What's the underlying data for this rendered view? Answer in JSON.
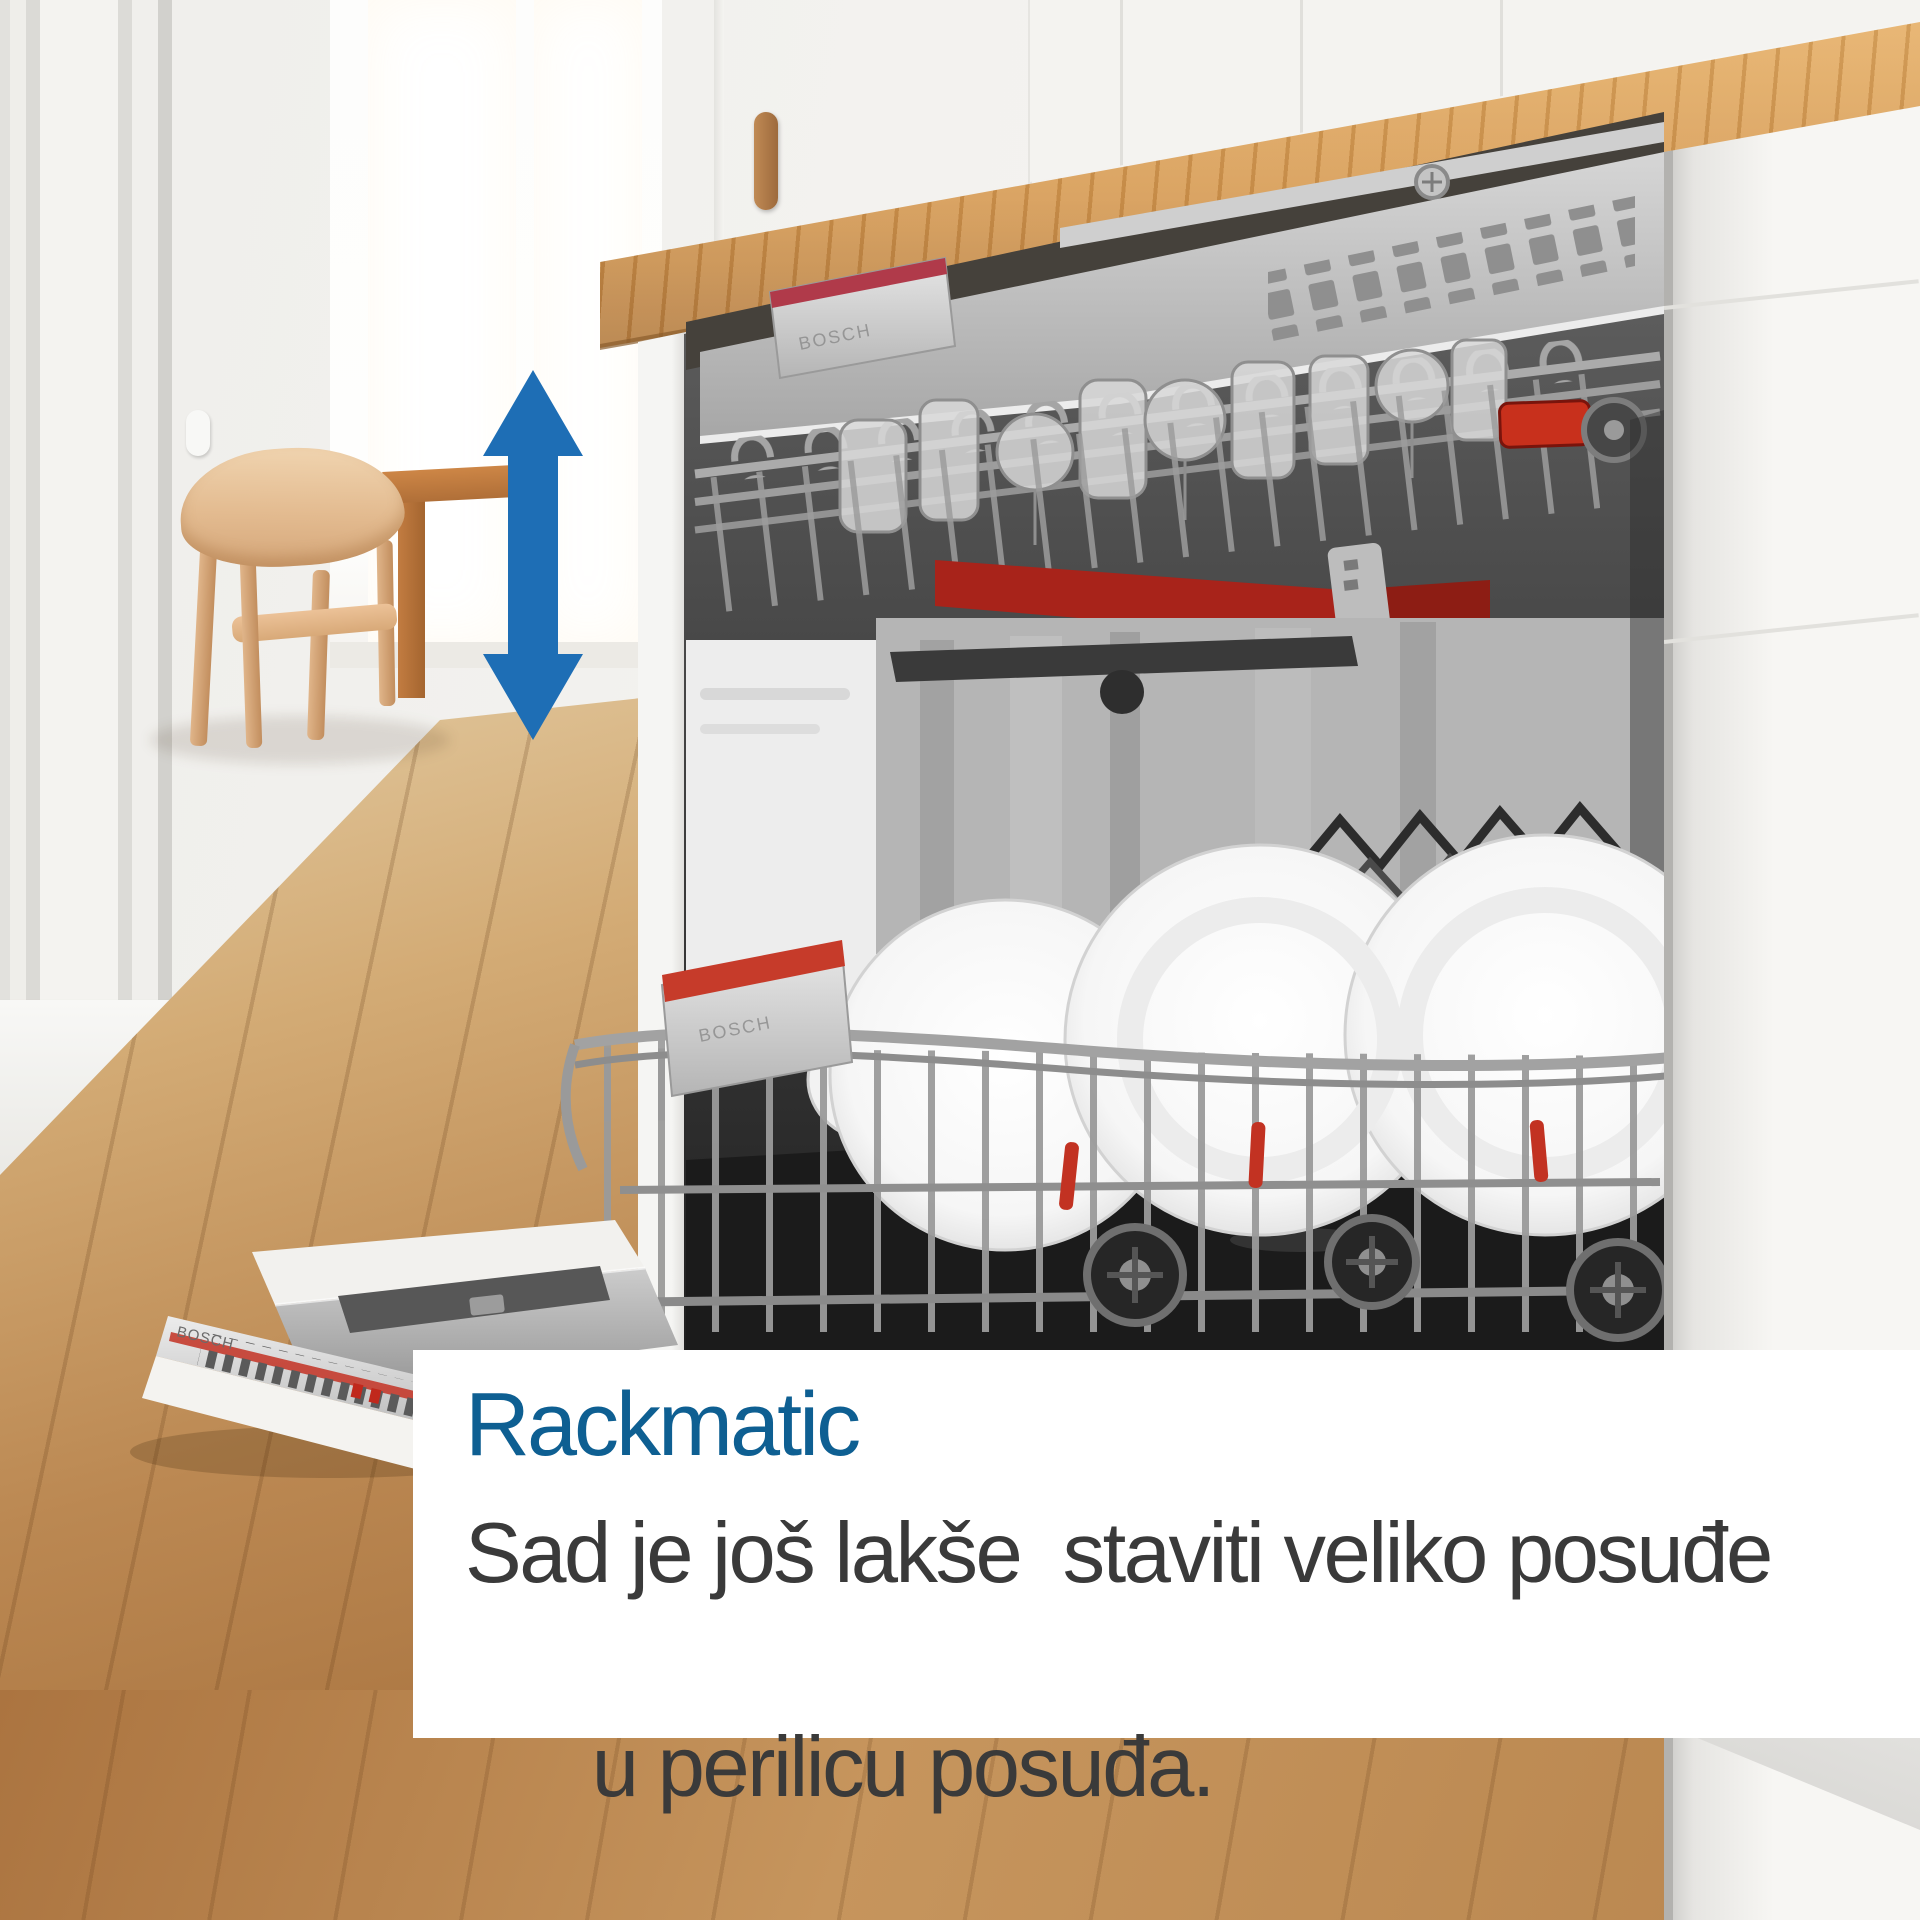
{
  "overlay": {
    "title": "Rackmatic",
    "body_line1": "Sad je još lakše  staviti veliko posuđe",
    "body_line2": "u perilicu posuđa."
  },
  "branding": {
    "door_logo": "BOSCH",
    "rack_handle_upper_logo": "BOSCH",
    "rack_handle_lower_logo": "BOSCH"
  },
  "icons": {
    "height_adjust_arrow": "vertical-double-arrow-icon"
  },
  "colors": {
    "headline_blue": "#0e5f92",
    "arrow_blue": "#1e6eb5",
    "accent_red": "#c62a18",
    "body_text": "#3a3a3a",
    "box_background": "#ffffff",
    "counter_wood": "#d69a52",
    "floor_wood": "#bb8852"
  }
}
